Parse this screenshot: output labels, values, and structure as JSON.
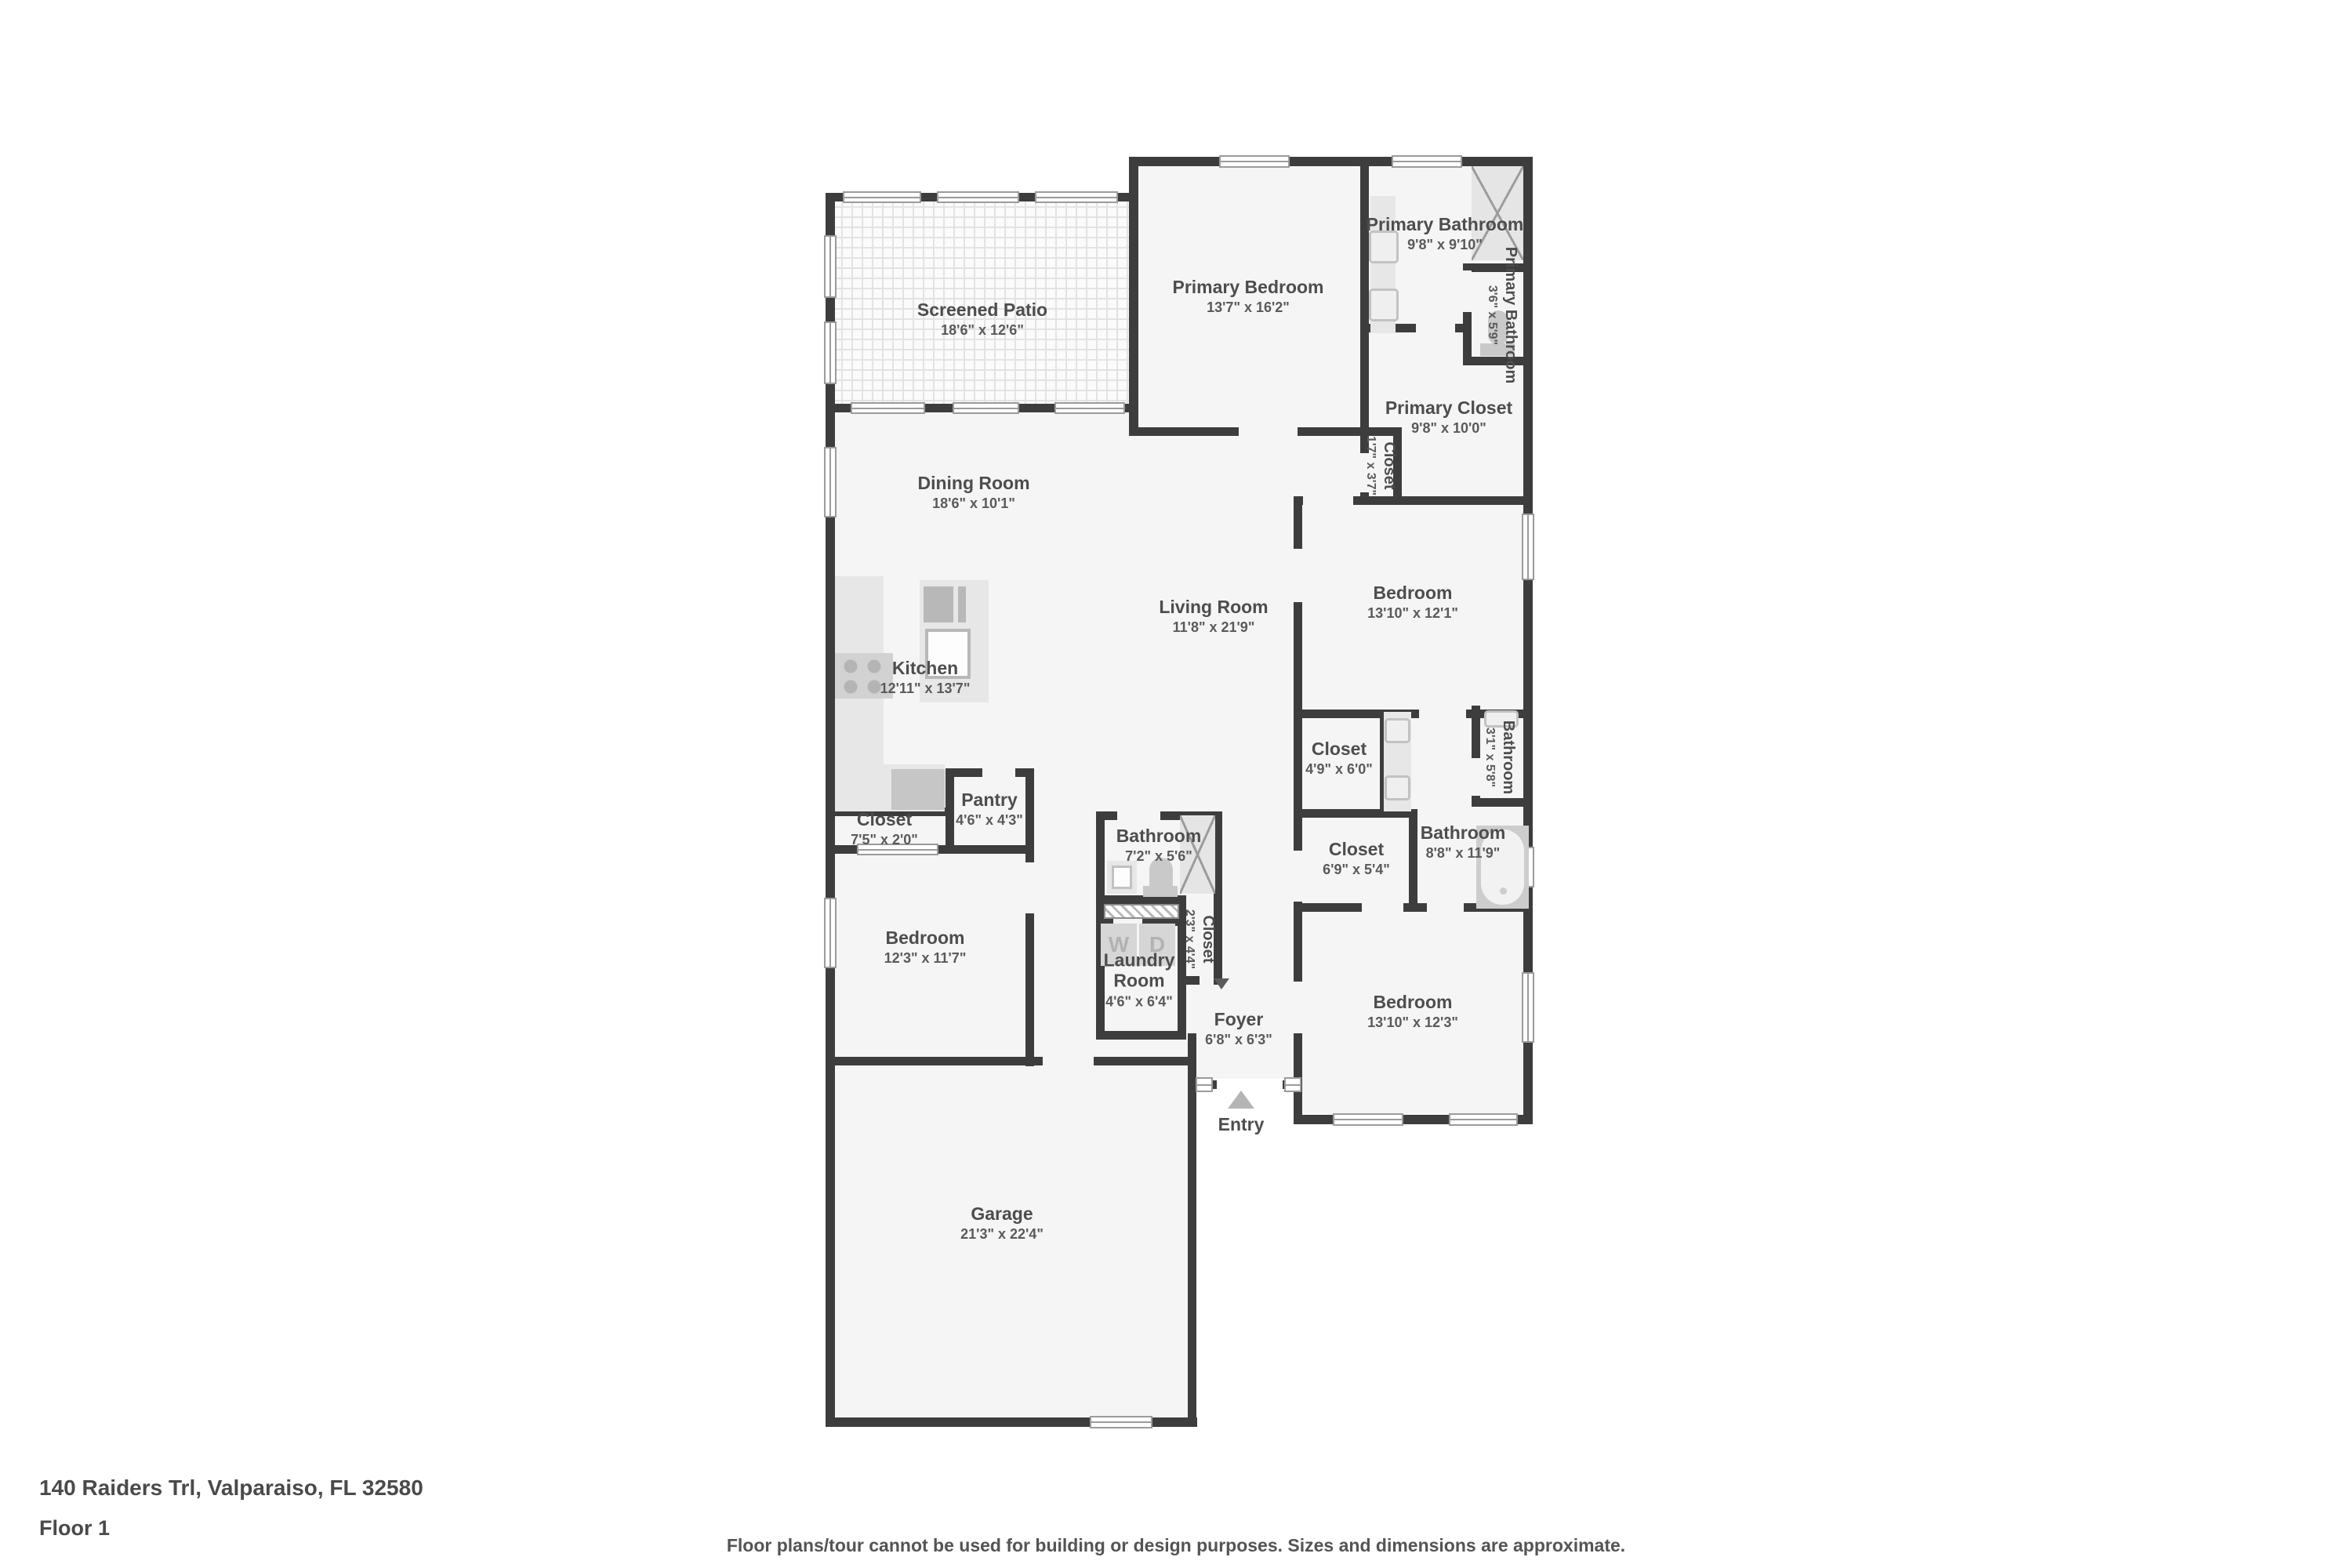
{
  "rooms": {
    "screened_patio": {
      "name": "Screened Patio",
      "dims": "18'6\" x 12'6\""
    },
    "primary_bedroom": {
      "name": "Primary Bedroom",
      "dims": "13'7\" x 16'2\""
    },
    "primary_bathroom": {
      "name": "Primary Bathroom",
      "dims": "9'8\" x 9'10\""
    },
    "primary_bathroom_wc": {
      "name": "Primary Bathroom",
      "dims": "3'6\" x 5'9\""
    },
    "primary_closet": {
      "name": "Primary Closet",
      "dims": "9'8\" x 10'0\""
    },
    "closet_hall": {
      "name": "Closet",
      "dims": "1'7\" x 3'7\""
    },
    "dining_room": {
      "name": "Dining Room",
      "dims": "18'6\" x 10'1\""
    },
    "living_room": {
      "name": "Living Room",
      "dims": "11'8\" x 21'9\""
    },
    "kitchen": {
      "name": "Kitchen",
      "dims": "12'11\" x 13'7\""
    },
    "bedroom_right": {
      "name": "Bedroom",
      "dims": "13'10\" x 12'1\""
    },
    "closet_right_upper": {
      "name": "Closet",
      "dims": "4'9\" x 6'0\""
    },
    "bathroom_small_right": {
      "name": "Bathroom",
      "dims": "3'1\" x 5'8\""
    },
    "pantry": {
      "name": "Pantry",
      "dims": "4'6\" x 4'3\""
    },
    "closet_left": {
      "name": "Closet",
      "dims": "7'5\" x 2'0\""
    },
    "bathroom_center": {
      "name": "Bathroom",
      "dims": "7'2\" x 5'6\""
    },
    "closet_right_lower": {
      "name": "Closet",
      "dims": "6'9\" x 5'4\""
    },
    "bathroom_right": {
      "name": "Bathroom",
      "dims": "8'8\" x 11'9\""
    },
    "bedroom_left": {
      "name": "Bedroom",
      "dims": "12'3\" x 11'7\""
    },
    "closet_center": {
      "name": "Closet",
      "dims": "2'3\" x 4'4\""
    },
    "laundry_room": {
      "name": "Laundry Room",
      "dims": "4'6\" x 6'4\""
    },
    "foyer": {
      "name": "Foyer",
      "dims": "6'8\" x 6'3\""
    },
    "bedroom_bottom_right": {
      "name": "Bedroom",
      "dims": "13'10\" x 12'3\""
    },
    "garage": {
      "name": "Garage",
      "dims": "21'3\" x 22'4\""
    }
  },
  "labels": {
    "entry": "Entry",
    "washer": "W",
    "dryer": "D"
  },
  "footer": {
    "address": "140 Raiders Trl, Valparaiso, FL 32580",
    "floor": "Floor 1",
    "disclaimer": "Floor plans/tour cannot be used for building or design purposes. Sizes and dimensions are approximate."
  },
  "colors": {
    "wall": "#3d3d3d",
    "floor": "#f5f5f5",
    "fixture": "#d6d6d6",
    "text": "#4d4d4d"
  }
}
